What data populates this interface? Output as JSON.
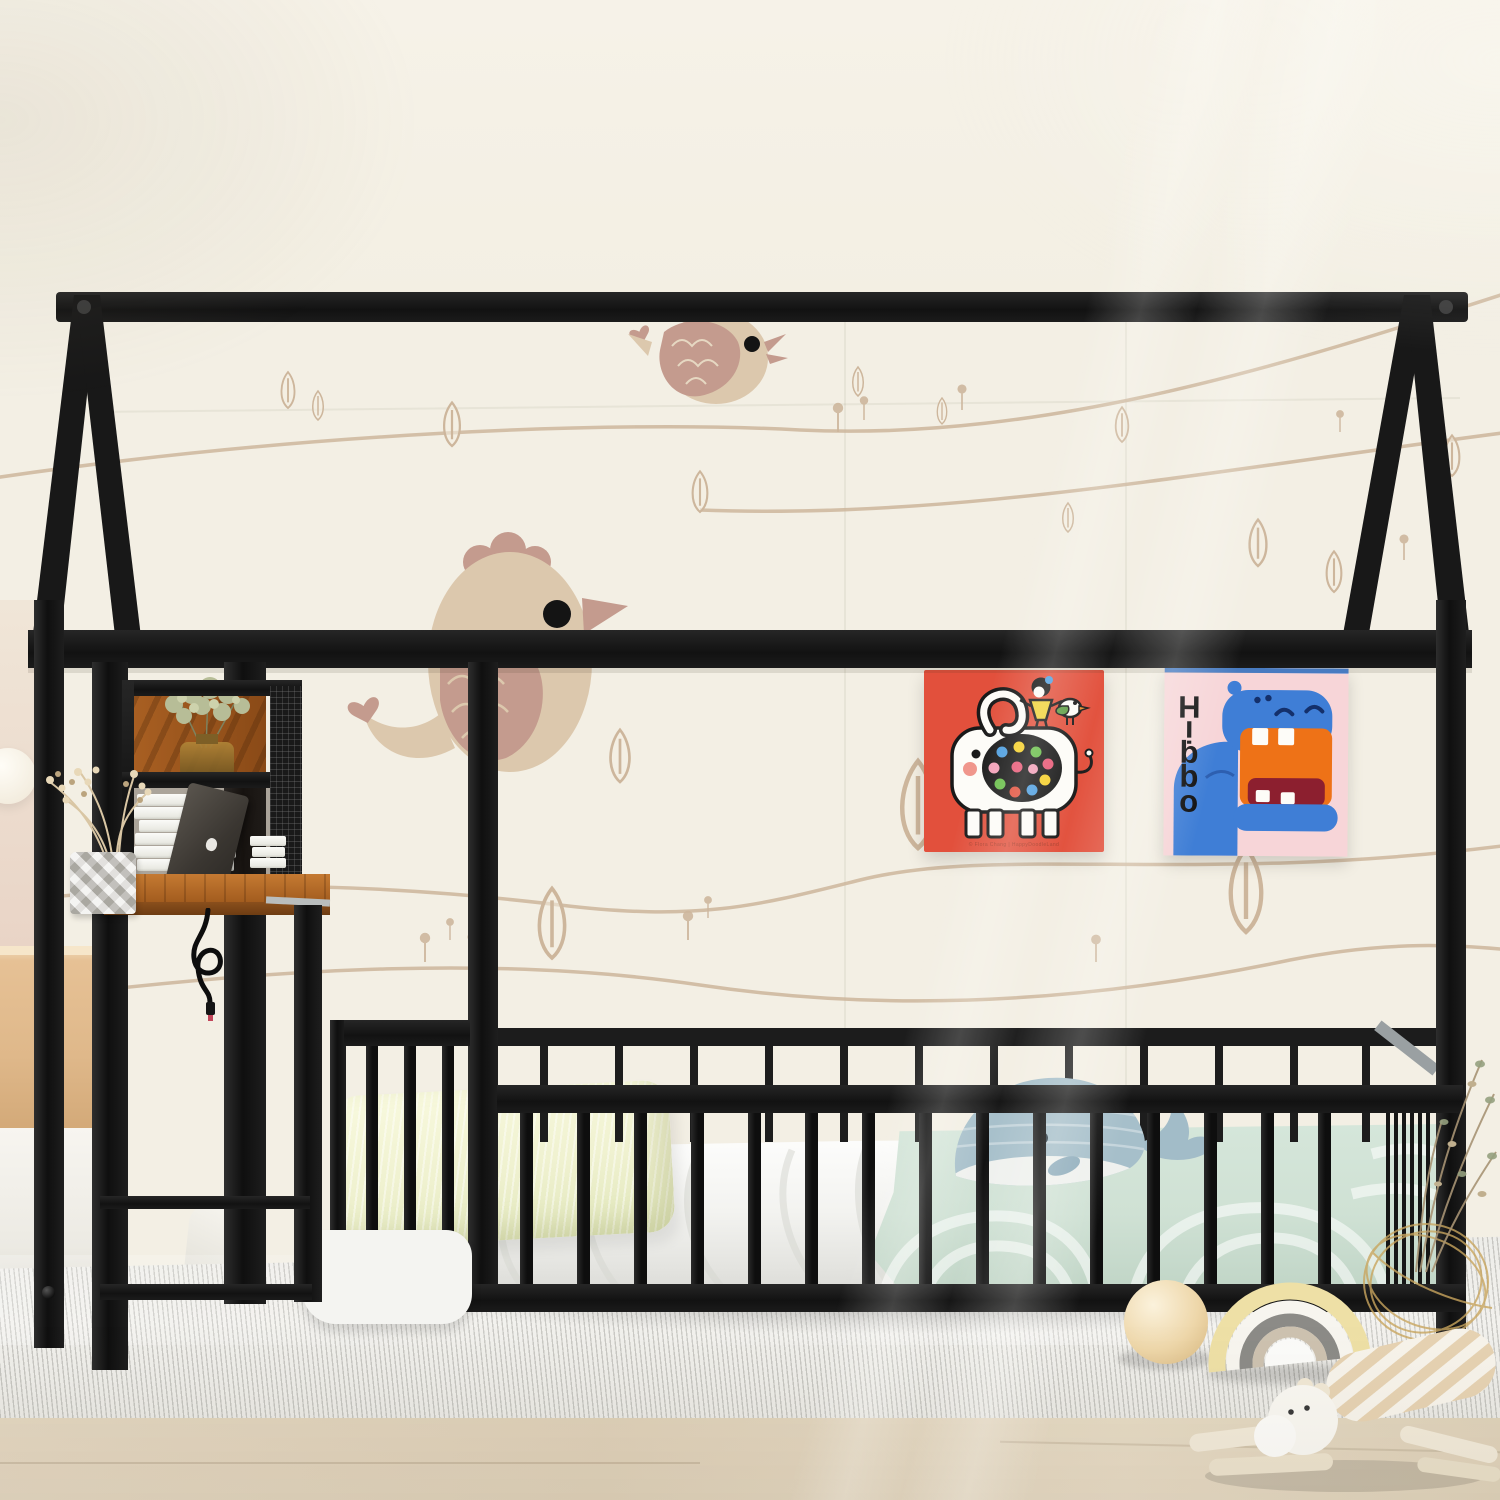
{
  "scene": {
    "type": "furniture product photo",
    "setting": "kids bedroom with illustrated bird wallpaper",
    "subject": "black metal house-shaped floor bed frame with built-in desk and shelf"
  },
  "posters": {
    "hippo": {
      "title": "Hippo",
      "bg_color": "#f7d5d8",
      "animal_color": "#3f7ed6",
      "mouth_color": "#ee7217",
      "throat_color": "#8c1f2f"
    },
    "elephant": {
      "credit": "© Flora Chang | HappyDoodleLand",
      "bg_color": "#e2503c",
      "dot_colors": [
        "#f5d02c",
        "#4f9fe0",
        "#6abf4b",
        "#e85a77",
        "#f2a0b8"
      ]
    }
  },
  "palette": {
    "frame_black": "#161616",
    "wall_cream": "#f3efe4",
    "mural_beige": "#cdb69c",
    "mural_pink": "#c49b8e",
    "blanket_mint": "#cfe1d4",
    "pillow_cream": "#f3f4d6",
    "desk_wood": "#b26a28",
    "rug": "#efeeea",
    "floor_wood": "#decfb9",
    "whale_blue": "#a6bfca",
    "toy_gold": "#c9a55e"
  },
  "objects": [
    "house bed frame",
    "ridge beam",
    "gables",
    "guardrail with slats",
    "floor mattress",
    "built-in desk",
    "shelf cubby",
    "glass vase with greenery",
    "book stack",
    "leaning tablet frame",
    "studded vase",
    "dried flowers",
    "usb charging cable",
    "cream pillow",
    "mint blanket",
    "whale plush",
    "elephant poster",
    "hippo poster",
    "striped rug",
    "wood ball",
    "rainbow stacker toy",
    "striped giraffe plush",
    "gold wire basket",
    "wood dresser",
    "sphere lamp"
  ]
}
